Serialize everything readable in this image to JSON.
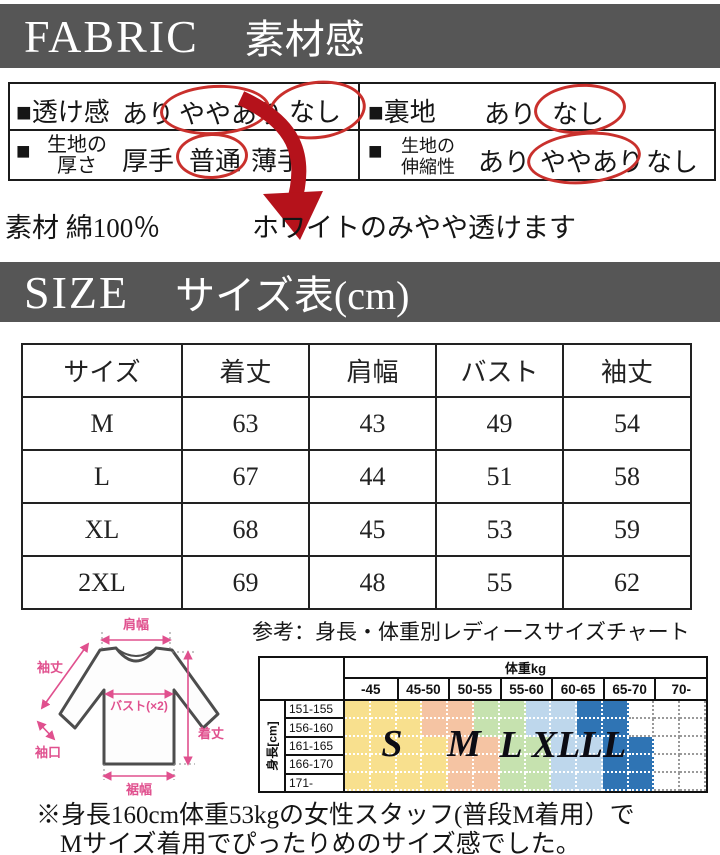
{
  "colors": {
    "header_bg": "#565656",
    "oval_red": "#c9302c",
    "annotation_red": "#b5121b",
    "dim_pink": "#e0508e"
  },
  "fabric": {
    "header": {
      "en": "FABRIC",
      "ja": "素材感"
    },
    "sheer": {
      "label": "■透け感",
      "opts": [
        "あり",
        "ややあり",
        "なし"
      ],
      "circled": [
        "ややあり",
        "なし"
      ]
    },
    "lining": {
      "label": "■裏地",
      "opts": [
        "あり",
        "なし"
      ],
      "circled": [
        "なし"
      ]
    },
    "thickness": {
      "bullet": "■",
      "label_line1": "生地の",
      "label_line2": "厚さ",
      "opts": [
        "厚手",
        "普通",
        "薄手"
      ],
      "circled": [
        "普通"
      ]
    },
    "stretch": {
      "bullet": "■",
      "label_line1": "生地の",
      "label_line2": "伸縮性",
      "opts": [
        "あり",
        "ややあり",
        "なし"
      ],
      "circled": [
        "ややあり"
      ]
    },
    "material_note": "素材 綿100％",
    "sheer_note": "ホワイトのみやや透けます"
  },
  "size": {
    "header": {
      "en": "SIZE",
      "ja": "サイズ表(cm)"
    },
    "table": {
      "headers": [
        "サイズ",
        "着丈",
        "肩幅",
        "バスト",
        "袖丈"
      ],
      "rows": [
        [
          "M",
          "63",
          "43",
          "49",
          "54"
        ],
        [
          "L",
          "67",
          "44",
          "51",
          "58"
        ],
        [
          "XL",
          "68",
          "45",
          "53",
          "59"
        ],
        [
          "2XL",
          "69",
          "48",
          "55",
          "62"
        ]
      ]
    }
  },
  "diagram": {
    "labels": {
      "shoulder": "肩幅",
      "sleeve": "袖丈",
      "bust": "バスト(×2)",
      "cuff": "袖口",
      "length": "着丈",
      "hem": "裾幅"
    }
  },
  "reference_chart": {
    "caption": "参考：身長・体重別レディースサイズチャート",
    "weight_header": "体重kg",
    "weight_cols": [
      "-45",
      "45-50",
      "50-55",
      "55-60",
      "60-65",
      "65-70",
      "70-"
    ],
    "height_label": "身長[cm]",
    "height_rows": [
      "151-155",
      "156-160",
      "161-165",
      "166-170",
      "171-"
    ],
    "size_letters": [
      "S",
      "M",
      "L",
      "XL",
      "LL"
    ],
    "bands": [
      "YYYPPGGBBDDWWW",
      "YYYPPGGBBDDWWW",
      "YYYYPPGGBBDDWW",
      "YYYYPPGGBBDDWW",
      "YYYYPPGGBBDDWW"
    ],
    "band_colors": {
      "Y": "#f8e08e",
      "P": "#f5c4a3",
      "G": "#c6e2af",
      "B": "#bed7ec",
      "D": "#2f74b4",
      "W": "#ffffff"
    }
  },
  "note": {
    "line1": "※身長160cm体重53kgの女性スタッフ(普段M着用）で",
    "line2": "Mサイズ着用でぴったりめのサイズ感でした。"
  }
}
